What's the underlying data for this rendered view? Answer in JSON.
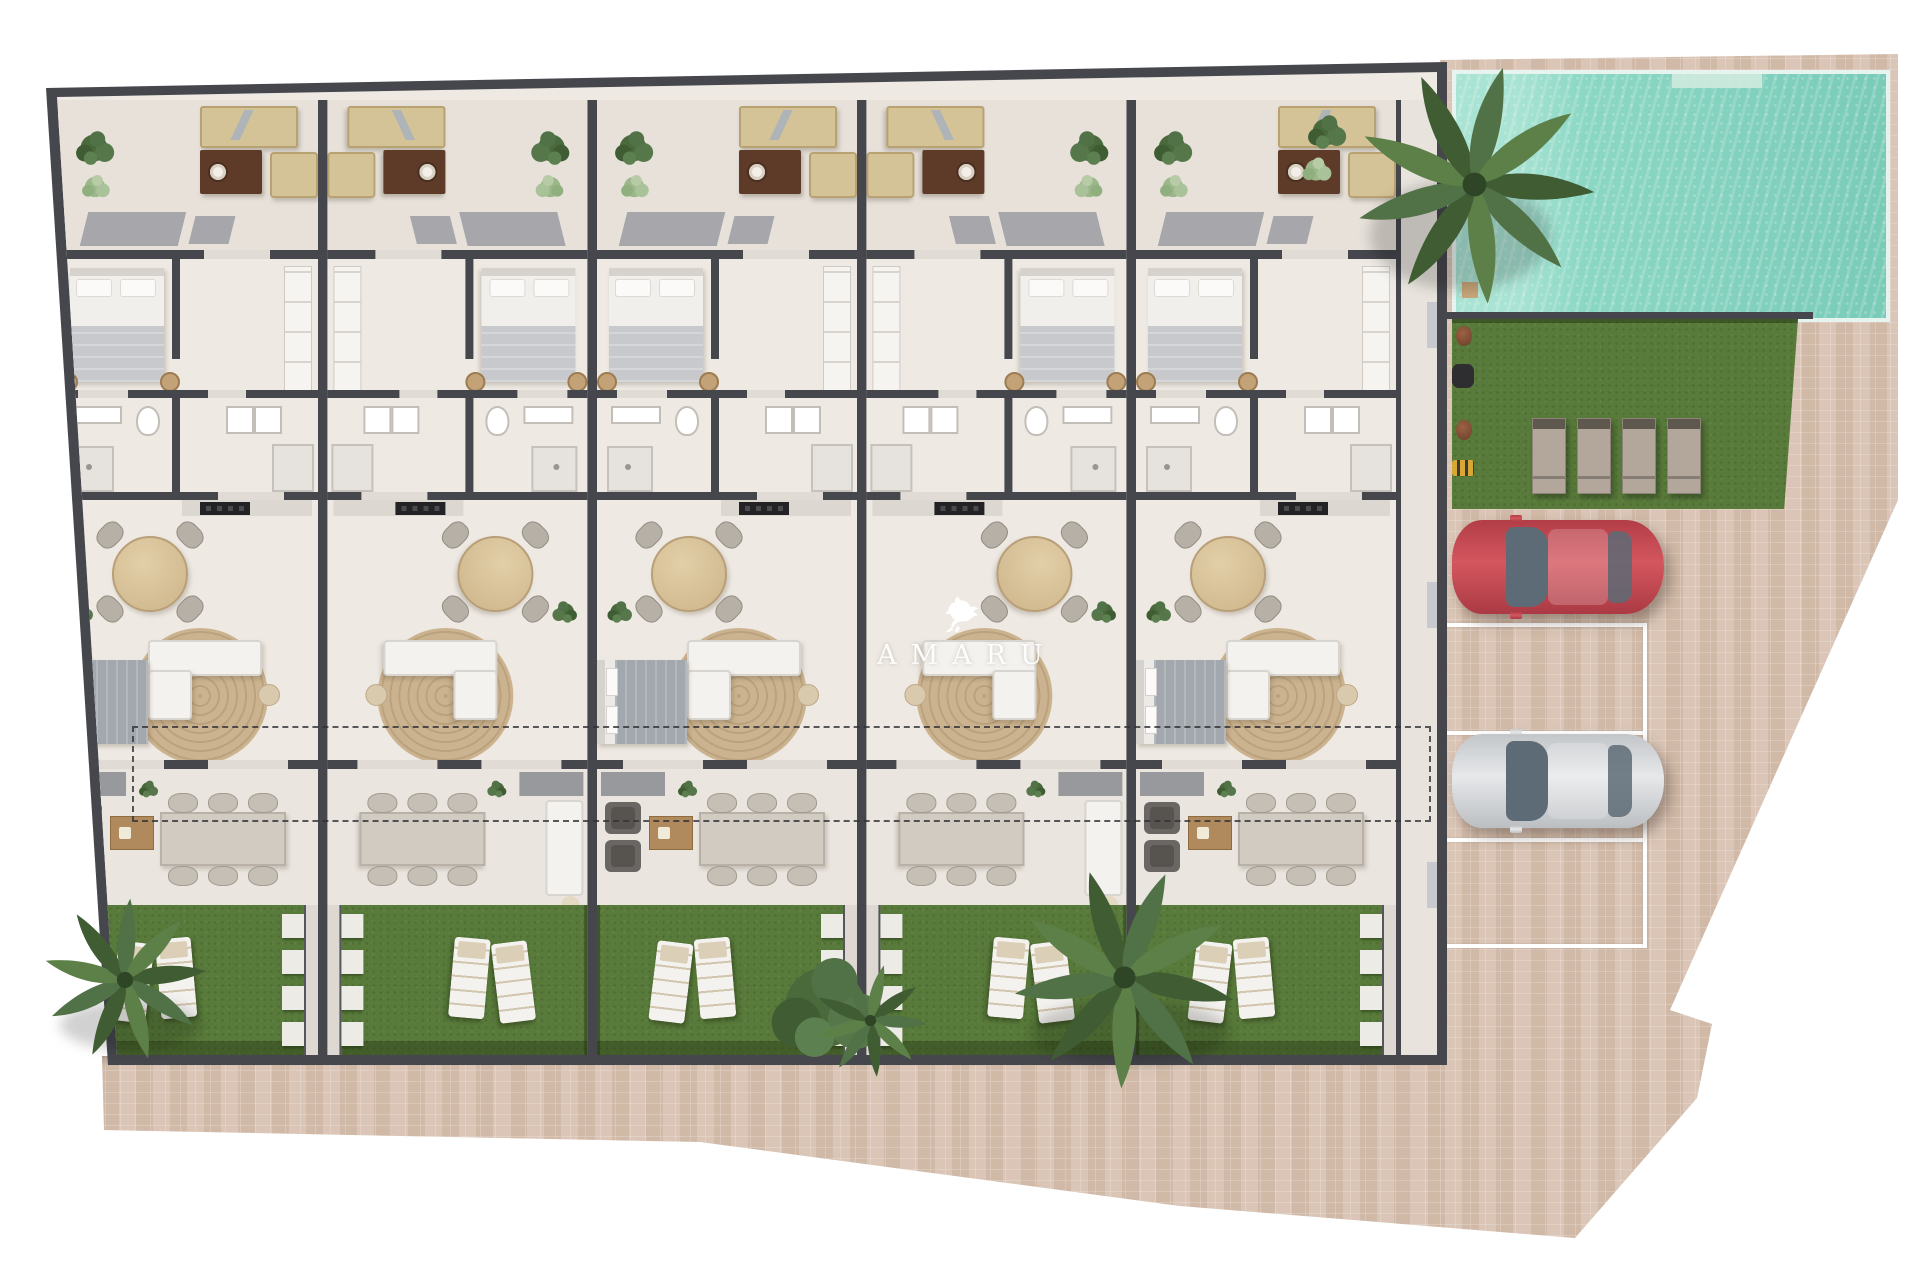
{
  "title": "Residential development site plan render",
  "watermark": {
    "logo": "pegasus-logo",
    "text": "AMARU"
  },
  "palette": {
    "wall": "#46474d",
    "floor": "#eee9e3",
    "terrace": "#e7e1da",
    "patio": "#eae5df",
    "corridor": "#e8e3dd",
    "path": "#ddd8d1",
    "garden": "#587a3a",
    "pool_water": "#84d2bf",
    "pool_water_light": "#a9e3d3",
    "pool_edge": "#e7f3ee",
    "pavement": "#d7c1b0",
    "pavement_line": "#ffffff",
    "rug": "#ccb38f",
    "wood": "#b08a5c",
    "sofa_beige": "#d5c398",
    "coffee_table_brown": "#5e3b29",
    "white_furniture": "#f4f2ef",
    "furniture_gray": "#b7b0a7",
    "dark_chair": "#6a6663",
    "bed_blanket": "#c7c9cc",
    "bed_gray": "#a2a8ae",
    "lawn_lounger": "#b3a79c",
    "canopy_gray": "#9a9ba2",
    "car_red": "#c64a52",
    "car_silver": "#d8dadc",
    "car_glass": "#5d6b76",
    "dash_line": "#3a3a3e"
  },
  "site": {
    "units": [
      {
        "id": 1,
        "mirrored": false,
        "lower_bedroom": true
      },
      {
        "id": 2,
        "mirrored": true,
        "lower_bedroom": false
      },
      {
        "id": 3,
        "mirrored": false,
        "lower_bedroom": true
      },
      {
        "id": 4,
        "mirrored": true,
        "lower_bedroom": false
      },
      {
        "id": 5,
        "mirrored": false,
        "lower_bedroom": true
      }
    ],
    "areas": [
      "roof-terraces",
      "bedrooms",
      "bathrooms",
      "kitchen-dining",
      "living-rooms",
      "covered-patios",
      "private-gardens",
      "communal-pool",
      "lawn",
      "parking",
      "paved-walkway"
    ],
    "pool": {
      "shape": "rectangular",
      "palm_trees": 1
    },
    "lawn_loungers": 4,
    "garden_loungers_per_unit": 2,
    "stepping_stones_per_path": 4,
    "parking": {
      "spaces": 4,
      "cars": [
        {
          "color": "red"
        },
        {
          "color": "silver"
        }
      ]
    }
  }
}
